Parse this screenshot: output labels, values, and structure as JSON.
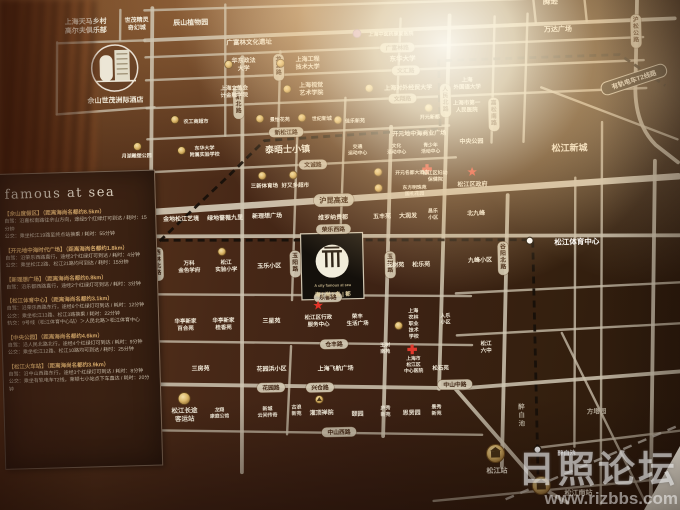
{
  "watermark": {
    "title": "日照论坛",
    "url": "www.rizbbs.com"
  },
  "panel": {
    "heading": "famous at sea",
    "sections": [
      {
        "title": "【佘山度假区】（距离海尚名都约8.5km）",
        "lines": [
          "自驾：沿嘉松南路往佘山方向，途经5个红绿灯可到达 / 耗时：15分钟",
          "公交：乘坐松江19路至终点站换乘 / 耗时：55分钟"
        ]
      },
      {
        "title": "【开元地中海时代广场】（距离海尚名都约1.8km）",
        "lines": [
          "自驾：沿荣乐西路直行，途经3个红绿灯可到达 / 耗时：4分钟",
          "公交：乘坐松江2路、松江21路均可到达 / 耗时：15分钟"
        ]
      },
      {
        "title": "【新理想广场】（距离海尚名都约0.8km）",
        "lines": [
          "自驾：沿乐都西路直行，途经2个红绿灯可到达 / 耗时：3分钟"
        ]
      },
      {
        "title": "【松江体育中心】（距离海尚名都约3.1km）",
        "lines": [
          "自驾：沿荣乐西路东行，途经6个红绿灯可到达 / 耗时：12分钟",
          "公交：乘坐松江13路、松江3路换乘 / 耗时：22分钟",
          "轨交：9号线（松江体育中心站）＞人民北路＞松江体育中心"
        ]
      },
      {
        "title": "【中央公园】（距离海尚名都约4.6km）",
        "lines": [
          "自驾：沿人民北路北行，途经4个红绿灯可到达 / 耗时：9分钟",
          "公交：乘坐松江12路、松江10路均可到达 / 耗时：25分钟"
        ]
      },
      {
        "title": "【松江火车站】（距离海尚名都约3.9km）",
        "lines": [
          "自驾：沿中山西路东行，途经3个红绿灯可到达 / 耗时：8分钟",
          "公交：乘坐有轨电车T2线，莱顿七小站点下车直达 / 耗时：20分钟"
        ]
      }
    ]
  },
  "map": {
    "tram_label": "有轨电车T2线路",
    "pills": [
      {
        "t": "广富林路",
        "x": 402,
        "y": 49
      },
      {
        "t": "文汇路",
        "x": 410,
        "y": 72
      },
      {
        "t": "文翔路",
        "x": 406,
        "y": 100
      },
      {
        "t": "新松江路",
        "x": 289,
        "y": 131
      },
      {
        "t": "文诚路",
        "x": 315,
        "y": 164
      },
      {
        "t": "沪昆高速",
        "x": 335,
        "y": 200,
        "big": true
      },
      {
        "t": "荣乐西路",
        "x": 334,
        "y": 229
      },
      {
        "t": "乐都路",
        "x": 327,
        "y": 297
      },
      {
        "t": "仓丰路",
        "x": 332,
        "y": 344
      },
      {
        "t": "花园路",
        "x": 268,
        "y": 386
      },
      {
        "t": "兴仓路",
        "x": 317,
        "y": 387
      },
      {
        "t": "中山中路",
        "x": 452,
        "y": 387
      },
      {
        "t": "中山西路",
        "x": 335,
        "y": 432
      },
      {
        "t": "三新北路",
        "x": 242,
        "y": 100,
        "v": true
      },
      {
        "t": "龙源路",
        "x": 283,
        "y": 66,
        "v": true
      },
      {
        "t": "玉阳路",
        "x": 295,
        "y": 263,
        "v": true
      },
      {
        "t": "西林北路",
        "x": 158,
        "y": 260,
        "v": true
      },
      {
        "t": "玉树路",
        "x": 390,
        "y": 266,
        "v": true
      },
      {
        "t": "人民北路",
        "x": 449,
        "y": 103,
        "v": true
      },
      {
        "t": "嘉松南路",
        "x": 497,
        "y": 118,
        "v": true
      },
      {
        "t": "谷阳北路",
        "x": 503,
        "y": 262,
        "v": true
      },
      {
        "t": "沪松公路",
        "x": 641,
        "y": 38,
        "v": true
      }
    ],
    "icons": [
      {
        "k": "gold",
        "x": 233,
        "y": 62
      },
      {
        "k": "gold",
        "x": 285,
        "y": 62
      },
      {
        "k": "gold",
        "x": 291,
        "y": 88
      },
      {
        "k": "gold",
        "x": 373,
        "y": 89
      },
      {
        "k": "purple",
        "x": 362,
        "y": 34
      },
      {
        "k": "gold",
        "x": 263,
        "y": 117
      },
      {
        "k": "gold",
        "x": 305,
        "y": 117
      },
      {
        "k": "gold",
        "x": 341,
        "y": 120
      },
      {
        "k": "gold",
        "x": 432,
        "y": 110
      },
      {
        "k": "gold",
        "x": 140,
        "y": 142
      },
      {
        "k": "gold",
        "x": 139,
        "y": 184
      },
      {
        "k": "gold",
        "x": 178,
        "y": 116
      },
      {
        "k": "gold",
        "x": 184,
        "y": 147
      },
      {
        "k": "gold",
        "x": 380,
        "y": 173
      },
      {
        "k": "gold",
        "x": 380,
        "y": 189
      },
      {
        "k": "gold",
        "x": 264,
        "y": 174
      },
      {
        "k": "gold",
        "x": 295,
        "y": 174
      },
      {
        "k": "gold",
        "x": 222,
        "y": 249
      },
      {
        "k": "cross",
        "x": 429,
        "y": 171
      },
      {
        "k": "star",
        "x": 474,
        "y": 175
      },
      {
        "k": "star",
        "x": 317,
        "y": 305
      },
      {
        "k": "gold",
        "x": 397,
        "y": 327
      },
      {
        "k": "cross",
        "x": 410,
        "y": 351
      },
      {
        "k": "temple",
        "x": 316,
        "y": 399
      },
      {
        "k": "gold",
        "x": 181,
        "y": 395,
        "r": 6
      },
      {
        "k": "stationb",
        "x": 491,
        "y": 457
      },
      {
        "k": "stationb",
        "x": 536,
        "y": 490
      }
    ],
    "labels": [
      {
        "t": "上海天马乡村\n高尔夫俱乐部",
        "x": 91,
        "y": 20,
        "fs": 7
      },
      {
        "t": "世茂精灵\n奇幻城",
        "x": 142,
        "y": 19,
        "fs": 6
      },
      {
        "t": "辰山植物园",
        "x": 196,
        "y": 19,
        "fs": 7
      },
      {
        "t": "广富林文化遗址",
        "x": 254,
        "y": 40,
        "fs": 6.5
      },
      {
        "t": "腾逊",
        "x": 556,
        "y": 6,
        "fs": 7.5
      },
      {
        "t": "万达广场",
        "x": 563,
        "y": 34,
        "fs": 7
      },
      {
        "t": "华东政法\n大学",
        "x": 248,
        "y": 62,
        "fs": 6
      },
      {
        "t": "上海工程\n技术大学",
        "x": 312,
        "y": 62,
        "fs": 6
      },
      {
        "t": "东华大学",
        "x": 407,
        "y": 60,
        "fs": 6.5
      },
      {
        "t": "上海中医药康复医院",
        "x": 396,
        "y": 35,
        "fs": 5
      },
      {
        "t": "上海立信会\n计金融学院",
        "x": 238,
        "y": 89,
        "fs": 5.5
      },
      {
        "t": "上海视觉\n艺术学院",
        "x": 315,
        "y": 88,
        "fs": 6
      },
      {
        "t": "上海对外经贸大学",
        "x": 412,
        "y": 89,
        "fs": 6
      },
      {
        "t": "上海\n外国语大学",
        "x": 471,
        "y": 86,
        "fs": 5.5
      },
      {
        "t": "上海市第一\n人民医院",
        "x": 470,
        "y": 109,
        "fs": 5.5
      },
      {
        "t": "中央公园",
        "x": 474,
        "y": 144,
        "fs": 6
      },
      {
        "t": "景怡花苑",
        "x": 283,
        "y": 118,
        "fs": 5
      },
      {
        "t": "世纪新城",
        "x": 325,
        "y": 118,
        "fs": 5
      },
      {
        "t": "佳乐新苑",
        "x": 358,
        "y": 121,
        "fs": 5
      },
      {
        "t": "开元新都",
        "x": 433,
        "y": 119,
        "fs": 5
      },
      {
        "t": "泰晤士小镇",
        "x": 290,
        "y": 148,
        "fs": 9,
        "w": 700
      },
      {
        "t": "松江区妇幼\n保健院",
        "x": 437,
        "y": 178,
        "fs": 5
      },
      {
        "t": "开元名都大酒店",
        "x": 414,
        "y": 174,
        "fs": 4.8
      },
      {
        "t": "东方明珠苑\n国礼花园",
        "x": 416,
        "y": 192,
        "fs": 4.8
      },
      {
        "t": "交通\n运动中心",
        "x": 360,
        "y": 150,
        "fs": 4.8
      },
      {
        "t": "文化\n活动中心",
        "x": 399,
        "y": 150,
        "fs": 4.8
      },
      {
        "t": "青少年\n活动中心",
        "x": 433,
        "y": 150,
        "fs": 4.8
      },
      {
        "t": "松江区政府",
        "x": 474,
        "y": 187,
        "fs": 6
      },
      {
        "t": "开元地中海商业广场",
        "x": 422,
        "y": 135,
        "fs": 6
      },
      {
        "t": "月湖雕塑公园",
        "x": 139,
        "y": 151,
        "fs": 5
      },
      {
        "t": "农工商超市",
        "x": 199,
        "y": 118,
        "fs": 5
      },
      {
        "t": "东华大学\n附属实验学校",
        "x": 207,
        "y": 148,
        "fs": 5
      },
      {
        "t": "世纪联华超市",
        "x": 140,
        "y": 193,
        "fs": 5
      },
      {
        "t": "佘山世茂洲际酒店",
        "x": 119,
        "y": 95,
        "fs": 7
      },
      {
        "t": "三新体育场",
        "x": 266,
        "y": 184,
        "fs": 5.5
      },
      {
        "t": "好又多超市",
        "x": 297,
        "y": 184,
        "fs": 5.5
      },
      {
        "t": "金地松江艺境",
        "x": 182,
        "y": 215,
        "fs": 6
      },
      {
        "t": "绿地蔷薇九里",
        "x": 226,
        "y": 215,
        "fs": 6
      },
      {
        "t": "新理想广场",
        "x": 268,
        "y": 214,
        "fs": 6
      },
      {
        "t": "维罗纳贵都",
        "x": 334,
        "y": 217,
        "fs": 6
      },
      {
        "t": "五丰苑",
        "x": 383,
        "y": 217,
        "fs": 6
      },
      {
        "t": "大润发",
        "x": 409,
        "y": 217,
        "fs": 6
      },
      {
        "t": "昌乐\n小区",
        "x": 434,
        "y": 216,
        "fs": 5
      },
      {
        "t": "北九峰",
        "x": 477,
        "y": 216,
        "fs": 6
      },
      {
        "t": "松江新城",
        "x": 572,
        "y": 153,
        "fs": 9,
        "w": 700
      },
      {
        "t": "万科\n金色学府",
        "x": 189,
        "y": 263,
        "fs": 5.5
      },
      {
        "t": "松江\n实验小学",
        "x": 226,
        "y": 263,
        "fs": 5.5
      },
      {
        "t": "玉乐小区",
        "x": 269,
        "y": 264,
        "fs": 6
      },
      {
        "t": "玉树苑",
        "x": 395,
        "y": 266,
        "fs": 6
      },
      {
        "t": "松乐苑",
        "x": 421,
        "y": 266,
        "fs": 6
      },
      {
        "t": "九峰小区",
        "x": 480,
        "y": 263,
        "fs": 6
      },
      {
        "t": "松江体育中心",
        "x": 577,
        "y": 247,
        "fs": 7.5,
        "c": "#ffffff",
        "w": 700
      },
      {
        "t": "华亭新家\n百合苑",
        "x": 184,
        "y": 321,
        "fs": 5.5
      },
      {
        "t": "华亭新家\n桂香苑",
        "x": 222,
        "y": 321,
        "fs": 5.5
      },
      {
        "t": "三星苑",
        "x": 270,
        "y": 319,
        "fs": 6
      },
      {
        "t": "松江区行政\n服务中心",
        "x": 317,
        "y": 320,
        "fs": 5.5
      },
      {
        "t": "荣丰\n生活广场",
        "x": 356,
        "y": 320,
        "fs": 5.5
      },
      {
        "t": "上海\n农林\n职业\n技术\n学校",
        "x": 412,
        "y": 325,
        "fs": 5
      },
      {
        "t": "人乐\n小区",
        "x": 444,
        "y": 321,
        "fs": 5
      },
      {
        "t": "玉树\n南苑",
        "x": 383,
        "y": 349,
        "fs": 5
      },
      {
        "t": "上海市\n松江区\n中心医院",
        "x": 411,
        "y": 366,
        "fs": 4.8
      },
      {
        "t": "松石苑",
        "x": 438,
        "y": 370,
        "fs": 5.5
      },
      {
        "t": "松江\n六中",
        "x": 484,
        "y": 350,
        "fs": 5.5
      },
      {
        "t": "三房苑",
        "x": 198,
        "y": 365,
        "fs": 6
      },
      {
        "t": "花园浜小区",
        "x": 269,
        "y": 367,
        "fs": 6
      },
      {
        "t": "上海飞航广场",
        "x": 333,
        "y": 368,
        "fs": 6
      },
      {
        "t": "新城\n云间传奇",
        "x": 264,
        "y": 410,
        "fs": 5
      },
      {
        "t": "古浪\n新苑",
        "x": 293,
        "y": 409,
        "fs": 5
      },
      {
        "t": "灌顶禅院",
        "x": 318,
        "y": 412,
        "fs": 6
      },
      {
        "t": "颐园",
        "x": 354,
        "y": 414,
        "fs": 6
      },
      {
        "t": "庐秀\n新苑",
        "x": 382,
        "y": 412,
        "fs": 5
      },
      {
        "t": "思贤园",
        "x": 408,
        "y": 414,
        "fs": 6
      },
      {
        "t": "景秀\n新苑",
        "x": 433,
        "y": 412,
        "fs": 5
      },
      {
        "t": "松江长途\n客运站",
        "x": 181,
        "y": 411,
        "fs": 6.5,
        "w": 700
      },
      {
        "t": "龙翔\n康庭公馆",
        "x": 216,
        "y": 410,
        "fs": 4.8
      },
      {
        "t": "醉\n白\n池",
        "x": 518,
        "y": 419,
        "fs": 6.5,
        "c": "#b5ab99"
      },
      {
        "t": "方塔园",
        "x": 593,
        "y": 417,
        "fs": 6.5,
        "c": "#b5ab99"
      },
      {
        "t": "松江站",
        "x": 492,
        "y": 474,
        "fs": 7,
        "w": 700
      },
      {
        "t": "松江南站",
        "x": 573,
        "y": 498,
        "fs": 7,
        "w": 700
      },
      {
        "t": "醉白池",
        "x": 562,
        "y": 458,
        "fs": 6,
        "c": "#ffffff"
      },
      {
        "t": "A city famous at sea",
        "x": 332,
        "y": 285,
        "fs": 3.8,
        "c": "#bfae86"
      },
      {
        "t": "海 | 尚 | 名 | 都",
        "x": 332,
        "y": 294,
        "fs": 5.5,
        "c": "#e3d3a6"
      }
    ]
  }
}
